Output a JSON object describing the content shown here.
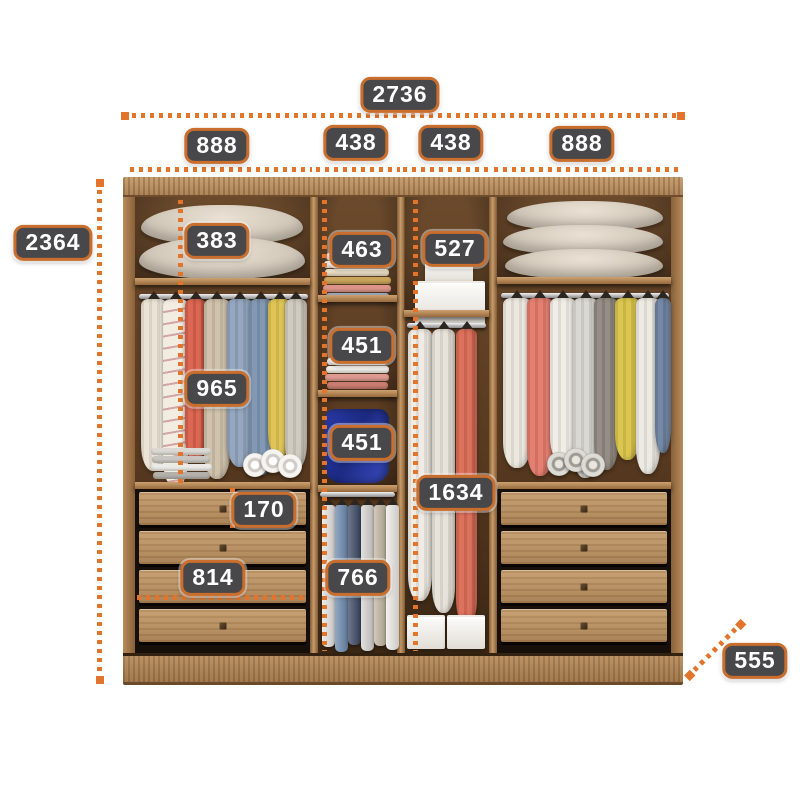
{
  "diagram": {
    "name": "Wardrobe interior dimensions diagram",
    "unit": "mm"
  },
  "colors": {
    "accent_orange": "#e2742c",
    "label_background": "#48484a",
    "label_border": "#c96e2d",
    "label_text": "#ffffff",
    "wood_frame": "#a87e52",
    "wood_light": "#c79c6a",
    "interior_dark": "#583a20",
    "page_background": "#ffffff"
  },
  "dims": {
    "total_width": "2736",
    "section_width_left": "888",
    "section_width_mid_left": "438",
    "section_width_mid_right": "438",
    "section_width_right": "888",
    "total_height": "2364",
    "left_top_shelf_height": "383",
    "mid_top_shelf_height": "463",
    "right_top_shelf_height": "527",
    "left_hanging_height": "965",
    "mid_shelf_height_1": "451",
    "mid_shelf_height_2": "451",
    "long_hanging_height": "1634",
    "drawer_height": "170",
    "drawer_width": "814",
    "pants_rail_height": "766",
    "depth": "555"
  }
}
